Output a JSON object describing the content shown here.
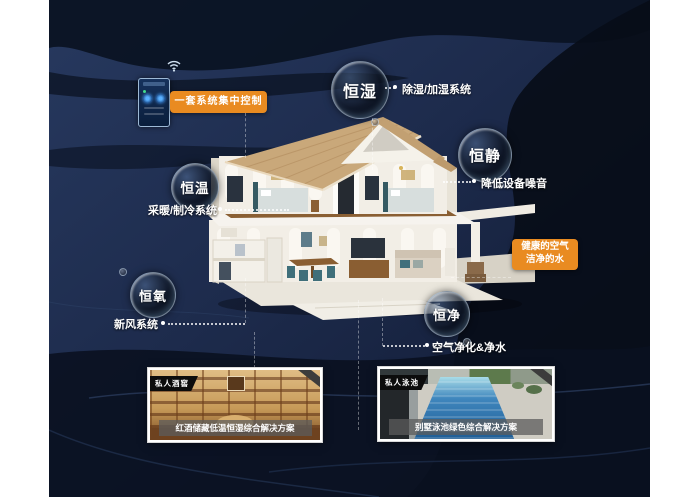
{
  "scene": {
    "background_base_color": "#1d2b4c",
    "background_streak_color": "#080d18",
    "wave_line_color": "#33486e",
    "accent_orange": "#e98b21"
  },
  "control_panel": {
    "label": "一套系统集中控制",
    "wifi_icon": "wifi-signal"
  },
  "bubbles": [
    {
      "label": "恒湿",
      "tag": "除湿/加湿系统"
    },
    {
      "label": "恒静",
      "tag": "降低设备噪音"
    },
    {
      "label": "恒温",
      "tag": "采暖/制冷系统"
    },
    {
      "label": "恒氧",
      "tag": "新风系统"
    },
    {
      "label": "恒净",
      "tag": "空气净化&净水"
    }
  ],
  "highlight": {
    "line1": "健康的空气",
    "line2": "洁净的水"
  },
  "cards": [
    {
      "tag": "私人酒窖",
      "caption": "红酒储藏低温恒湿综合解决方案"
    },
    {
      "tag": "私人泳池",
      "caption": "别墅泳池绿色综合解决方案"
    }
  ]
}
